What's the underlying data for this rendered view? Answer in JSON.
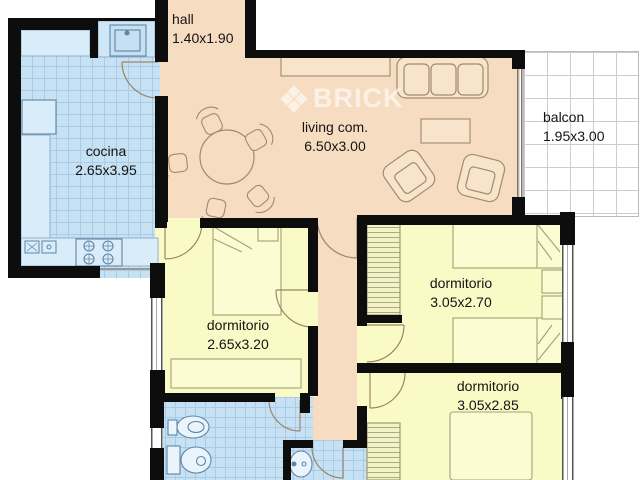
{
  "plan": {
    "watermark_text": "BRICK",
    "rooms": [
      {
        "name": "hall",
        "dims": "1.40x1.90"
      },
      {
        "name": "cocina",
        "dims": "2.65x3.95"
      },
      {
        "name": "living com.",
        "dims": "6.50x3.00"
      },
      {
        "name": "balcon",
        "dims": "1.95x3.00"
      },
      {
        "name": "dormitorio",
        "dims": "2.65x3.20"
      },
      {
        "name": "dormitorio",
        "dims": "3.05x2.70"
      },
      {
        "name": "dormitorio",
        "dims": "3.05x2.85"
      }
    ],
    "colors": {
      "wall": "#0d0d0d",
      "living_fill": "#f6dcc1",
      "bedroom_fill": "#fafac6",
      "wet_room_fill": "#c7e1f4",
      "balcony_grid": "#cccccc",
      "watermark": "rgba(255,255,255,0.6)"
    },
    "furniture_icons": [
      "dining-table",
      "dining-chair",
      "sofa",
      "armchair",
      "coffee-table",
      "sideboard",
      "single-bed",
      "double-bed",
      "wardrobe",
      "dresser",
      "nightstand",
      "toilet",
      "bidet",
      "washbasin",
      "kitchen-sink",
      "stove",
      "fridge",
      "counter",
      "door-arc",
      "window"
    ]
  }
}
